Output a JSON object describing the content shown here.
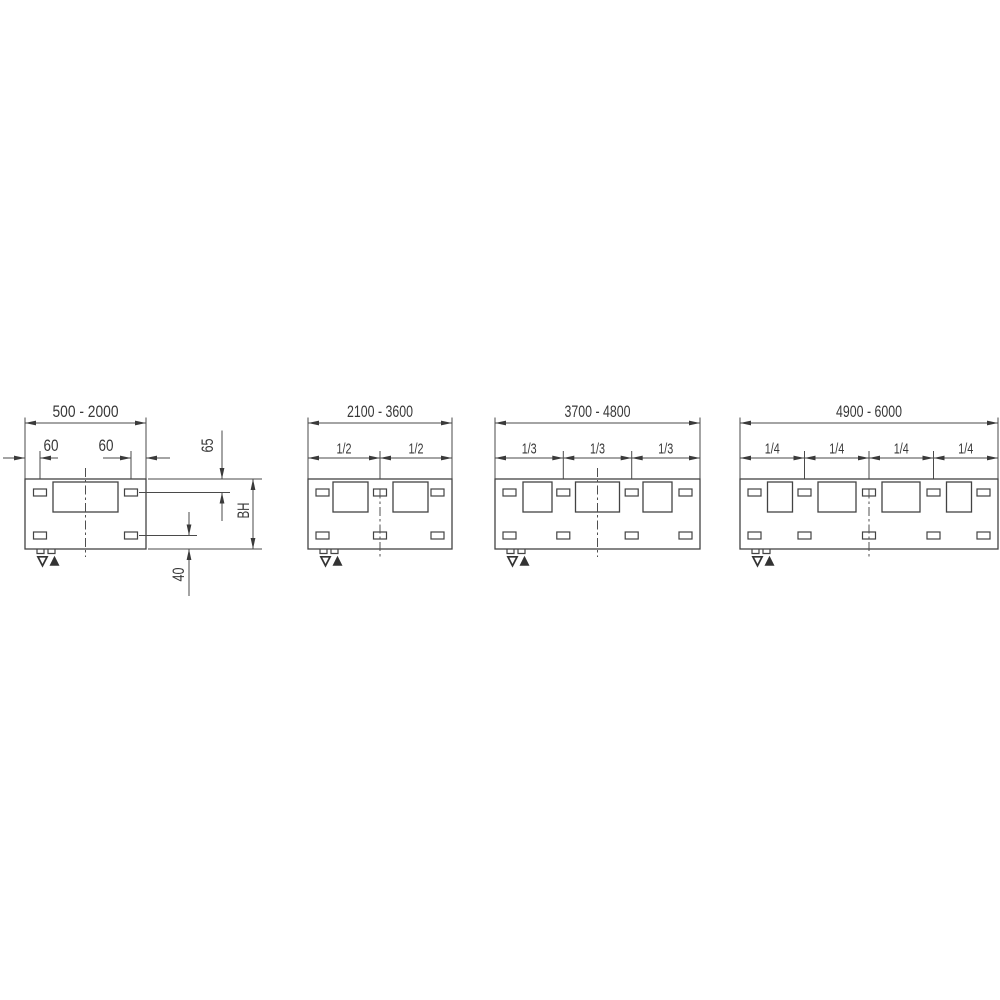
{
  "drawing": {
    "kind": "panel-length-dimension-diagram",
    "background": "#ffffff"
  },
  "colors": {
    "line": "#4a4a4a",
    "panel_line": "#434343",
    "text": "#383838",
    "arrow": "#3a3a3a"
  },
  "symbols": {
    "drain_triangle": "▽",
    "vent_triangle": "▲"
  },
  "diagrams": [
    {
      "name": "panel-type-1",
      "length_range": "500 - 2000",
      "segment_labels": [
        "60",
        "60"
      ],
      "side_dimensions": {
        "top_offset": "65",
        "height": "BH",
        "bottom_offset": "40"
      }
    },
    {
      "name": "panel-type-2",
      "length_range": "2100 - 3600",
      "segment_labels": [
        "1/2",
        "1/2"
      ]
    },
    {
      "name": "panel-type-3",
      "length_range": "3700 - 4800",
      "segment_labels": [
        "1/3",
        "1/3",
        "1/3"
      ]
    },
    {
      "name": "panel-type-4",
      "length_range": "4900 - 6000",
      "segment_labels": [
        "1/4",
        "1/4",
        "1/4",
        "1/4"
      ]
    }
  ]
}
